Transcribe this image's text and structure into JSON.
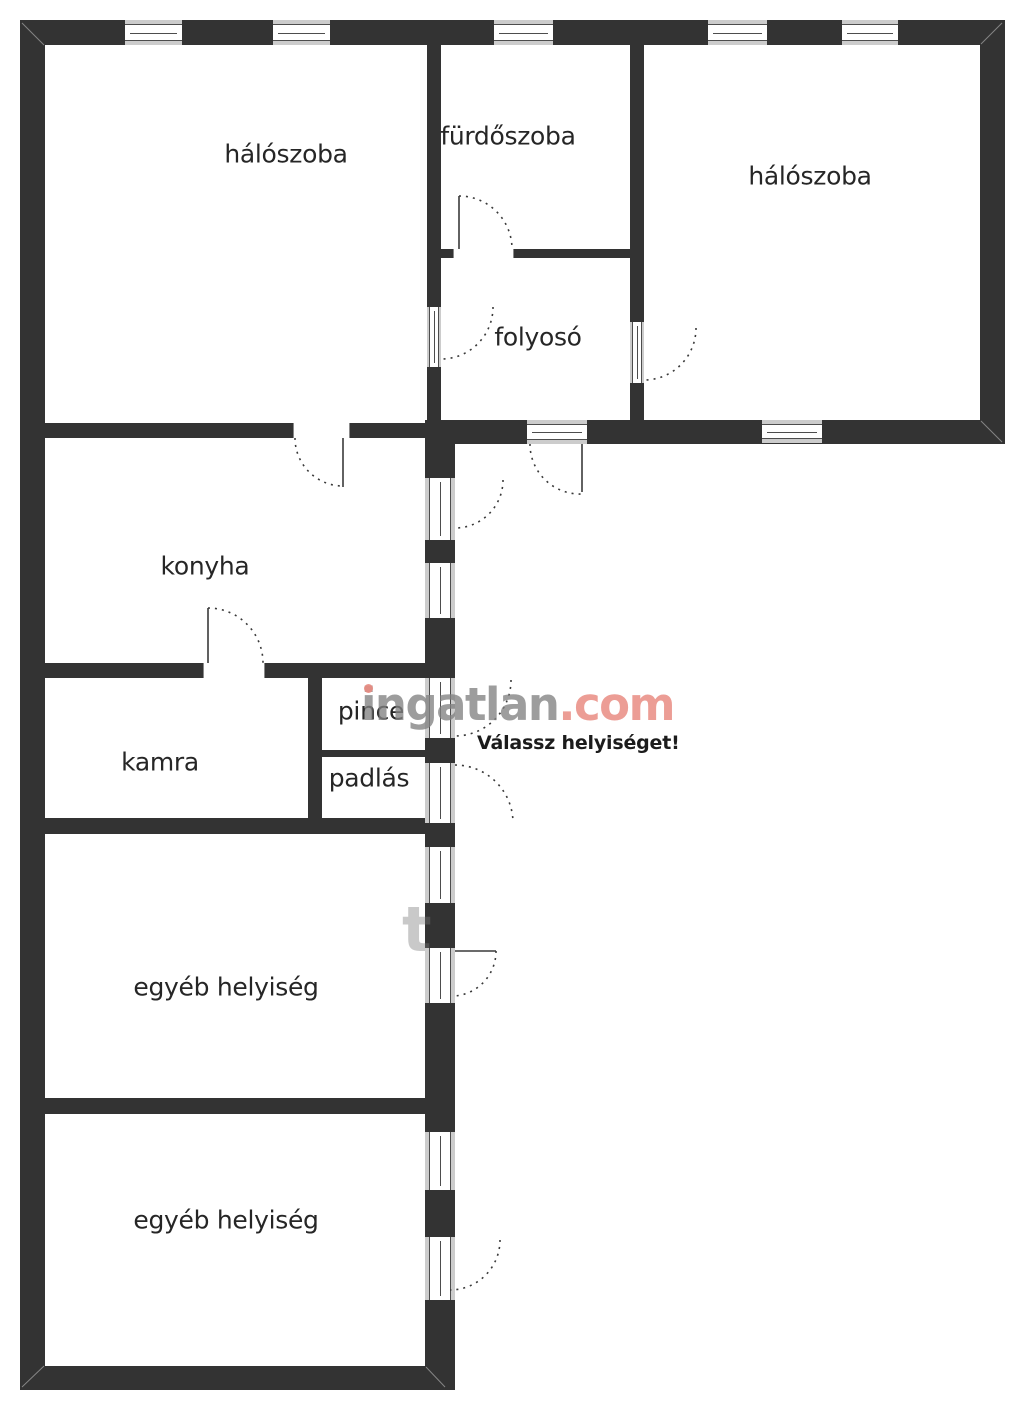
{
  "watermark": {
    "brand_gray": "ingatlan",
    "brand_accent": ".com",
    "prompt": "Válassz helyiséget!",
    "fragment": "t"
  },
  "colors": {
    "wall": "#333333",
    "window_gray": "#cccccc",
    "frame_line": "#4d4d4d",
    "brand_gray": "#828282",
    "brand_salmon": "#e98c82",
    "label_text": "#262626",
    "background": "#ffffff"
  },
  "rooms": [
    {
      "id": "haloszoba-1",
      "label": "hálószoba"
    },
    {
      "id": "furdoszoba",
      "label": "fürdőszoba"
    },
    {
      "id": "haloszoba-2",
      "label": "hálószoba"
    },
    {
      "id": "folyoso",
      "label": "folyosó"
    },
    {
      "id": "konyha",
      "label": "konyha"
    },
    {
      "id": "kamra",
      "label": "kamra"
    },
    {
      "id": "pince",
      "label": "pince"
    },
    {
      "id": "padlas",
      "label": "padlás"
    },
    {
      "id": "egyeb-1",
      "label": "egyéb helyiség"
    },
    {
      "id": "egyeb-2",
      "label": "egyéb helyiség"
    }
  ]
}
